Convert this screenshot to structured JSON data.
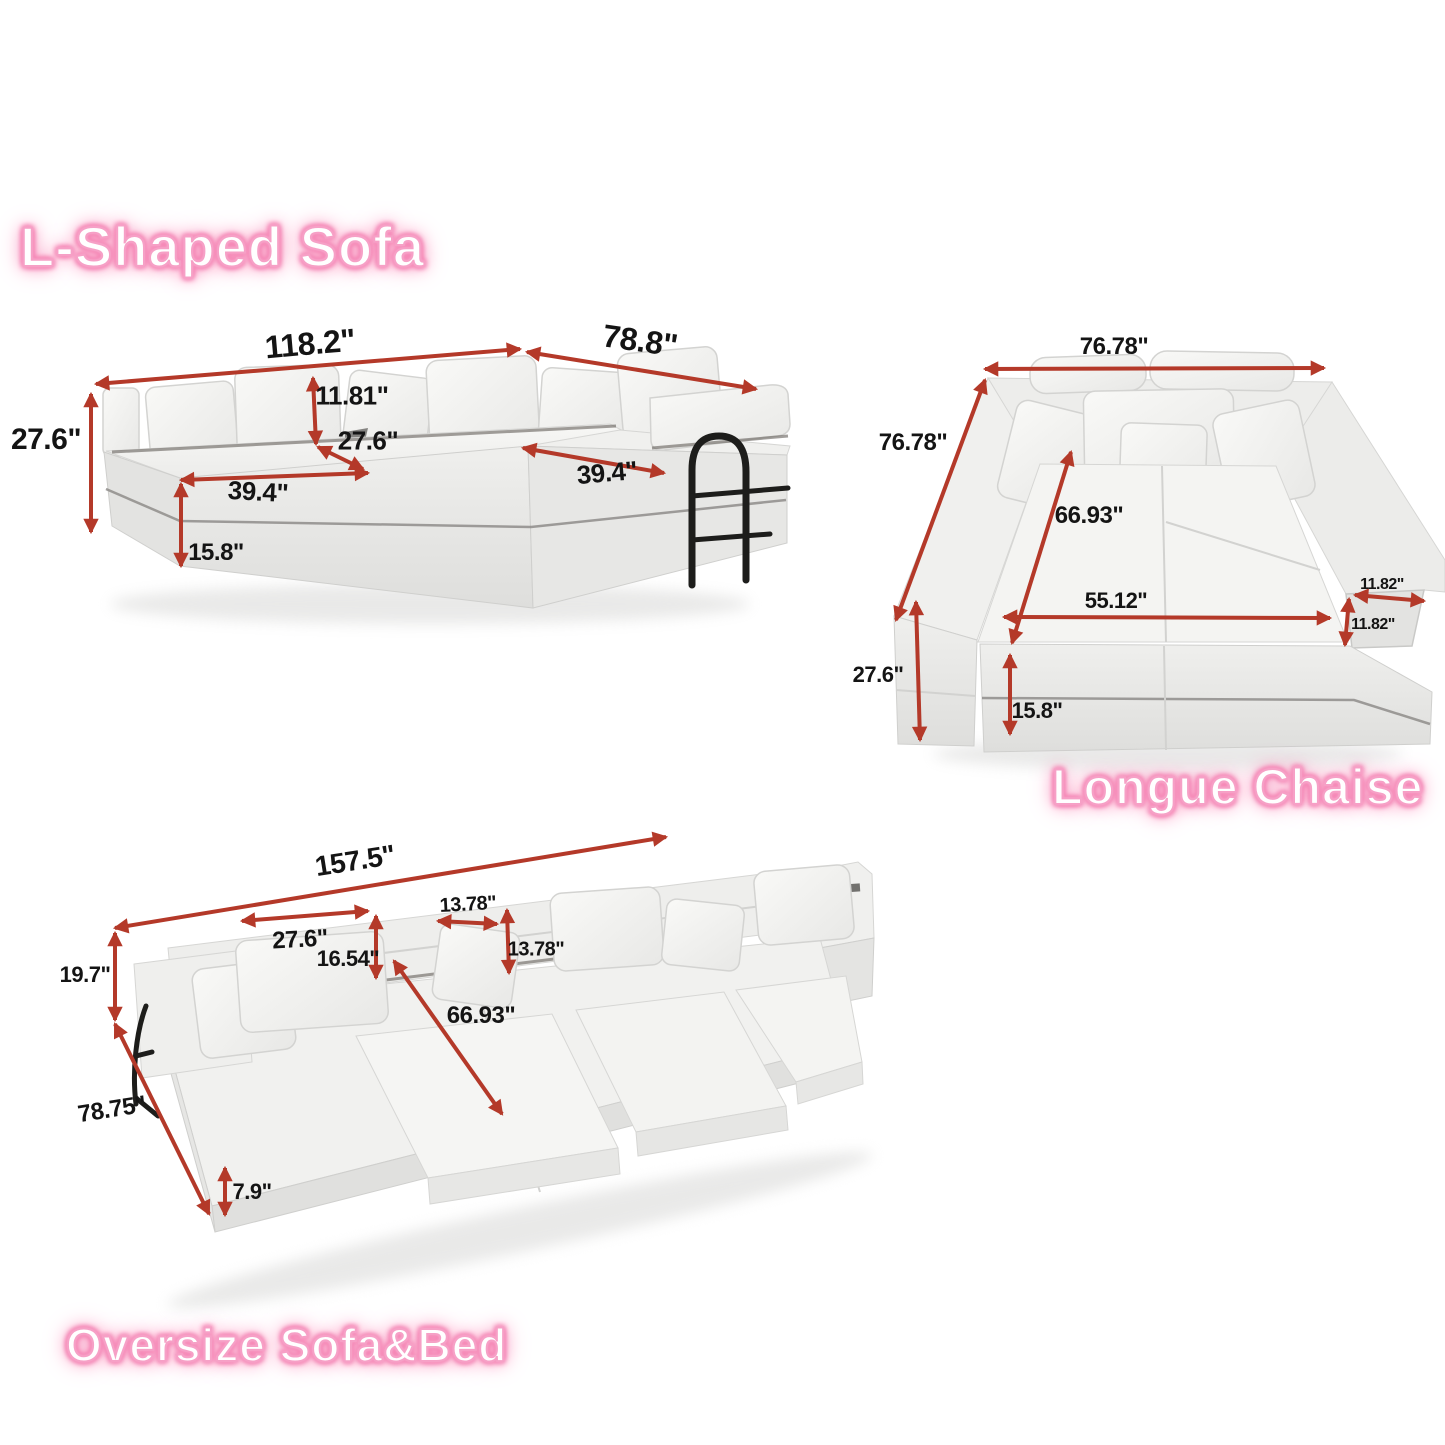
{
  "page": {
    "background": "#ffffff",
    "arrow_color": "#b43929",
    "label_color": "#141414",
    "title_fill": "#ffffff",
    "title_glow": "#f584b4"
  },
  "sections": [
    {
      "title": "L-Shaped Sofa",
      "dims": {
        "overall_width": "118.2\"",
        "chaise_width": "78.8\"",
        "overall_height": "27.6\"",
        "back_pillow_height": "11.81\"",
        "seat_depth": "27.6\"",
        "seat_width_left": "39.4\"",
        "seat_width_right": "39.4\"",
        "base_height": "15.8\""
      }
    },
    {
      "title": "Longue Chaise",
      "dims": {
        "overall_width": "76.78\"",
        "overall_depth": "76.78\"",
        "seat_diagonal": "66.93\"",
        "inner_width": "55.12\"",
        "arm_width": "11.82\"",
        "arm_thickness": "11.82\"",
        "overall_height": "27.6\"",
        "base_height": "15.8\""
      }
    },
    {
      "title": "Oversize Sofa&Bed",
      "dims": {
        "overall_width": "157.5\"",
        "back_pillow_width": "27.6\"",
        "small_pillow_width": "13.78\"",
        "back_pillow_height": "16.54\"",
        "small_pillow_height": "13.78\"",
        "back_height": "19.7\"",
        "bed_diagonal": "66.93\"",
        "overall_depth": "78.75\"",
        "mattress_height": "7.9\""
      }
    }
  ]
}
